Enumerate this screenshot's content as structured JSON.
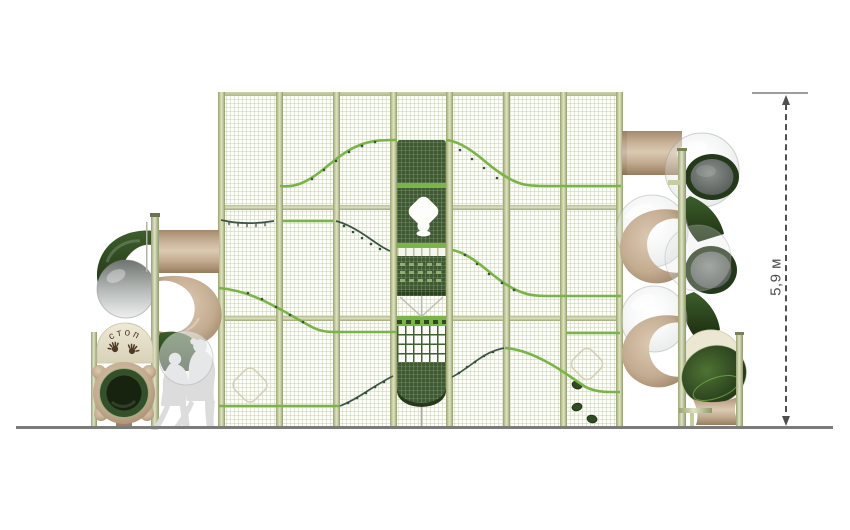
{
  "annotations": {
    "height_dimension": {
      "label": "5,9 м"
    },
    "stop_sign": {
      "label": "стоп",
      "handprint_count": 2
    }
  },
  "structure": {
    "wall": {
      "panel_count": 7,
      "row_count": 3
    },
    "tower": {
      "position": "center panel"
    },
    "slides": {
      "left": "spiral tube slide with stop-sign exit",
      "right": "double spiral tube slide"
    },
    "figures": {
      "count": 2
    }
  },
  "colors": {
    "frame": "#c6cd9e",
    "mesh_background": "#fdfdfa",
    "mesh_grid": "#dbe1cc",
    "accent_green": "#79b446",
    "panel_green": "#3f5a33",
    "rope_dark_green": "#3b5444",
    "tube_tan": "#c9b29a",
    "tube_dark_green": "#2c431f",
    "transparent_segment": "#ccd0ce",
    "cream_disc": "#ebe7d2",
    "sign_text_brown": "#4e3b25",
    "silhouette_gray": "#dcdcdc",
    "ground": "#7b7b7b",
    "dimension_gray": "#4f4f4f"
  }
}
